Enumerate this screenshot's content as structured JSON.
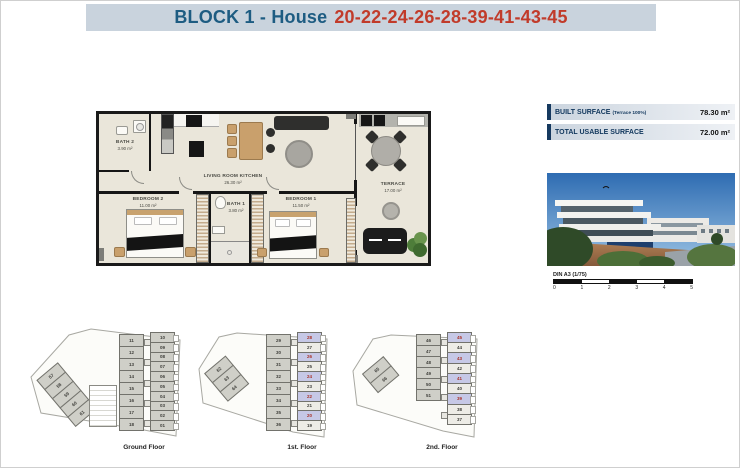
{
  "header": {
    "title_prefix": "BLOCK 1 - House",
    "title_numbers": "20-22-24-26-28-39-41-43-45"
  },
  "plan": {
    "rooms": {
      "bath2": {
        "name": "BATH 2",
        "area": "3.90 m²"
      },
      "living": {
        "name": "LIVING ROOM KITCHEN",
        "area": "26.30 m²"
      },
      "bedroom2": {
        "name": "BEDROOM 2",
        "area": "11.00 m²"
      },
      "bath1": {
        "name": "BATH 1",
        "area": "3.80 m²"
      },
      "bedroom1": {
        "name": "BEDROOM 1",
        "area": "11.50 m²"
      },
      "terrace": {
        "name": "TERRACE",
        "area": "17.00 m²"
      }
    }
  },
  "surface_table": {
    "rows": [
      {
        "label": "BUILT SURFACE",
        "note": "(Terrace 100%)",
        "value": "78.30 m²"
      },
      {
        "label": "TOTAL USABLE SURFACE",
        "note": "",
        "value": "72.00 m²"
      }
    ]
  },
  "scale_bar": {
    "label": "DIN A3 (1/75)",
    "ticks": [
      "0",
      "1",
      "2",
      "3",
      "4",
      "5"
    ]
  },
  "floors": [
    {
      "label": "Ground Floor",
      "strip": [
        {
          "n": "57",
          "t": "g"
        },
        {
          "n": "58",
          "t": "g"
        },
        {
          "n": "59",
          "t": "g"
        },
        {
          "n": "60",
          "t": "g"
        },
        {
          "n": "61",
          "t": "g"
        }
      ],
      "left_col": [
        {
          "n": "11",
          "t": "g"
        },
        {
          "n": "12",
          "t": "g"
        },
        {
          "n": "13",
          "t": "g"
        },
        {
          "n": "14",
          "t": "g"
        },
        {
          "n": "15",
          "t": "g"
        },
        {
          "n": "16",
          "t": "g"
        },
        {
          "n": "17",
          "t": "g"
        },
        {
          "n": "18",
          "t": "g"
        }
      ],
      "right_col": [
        {
          "n": "10",
          "t": "g"
        },
        {
          "n": "09",
          "t": "g"
        },
        {
          "n": "08",
          "t": "g"
        },
        {
          "n": "07",
          "t": "g"
        },
        {
          "n": "06",
          "t": "g"
        },
        {
          "n": "05",
          "t": "g"
        },
        {
          "n": "04",
          "t": "g"
        },
        {
          "n": "03",
          "t": "g"
        },
        {
          "n": "02",
          "t": "g"
        },
        {
          "n": "01",
          "t": "g"
        }
      ]
    },
    {
      "label": "1st. Floor",
      "strip": [
        {
          "n": "62",
          "t": "g"
        },
        {
          "n": "63",
          "t": "g"
        },
        {
          "n": "64",
          "t": "g"
        }
      ],
      "left_col": [
        {
          "n": "29",
          "t": "g"
        },
        {
          "n": "30",
          "t": "g"
        },
        {
          "n": "31",
          "t": "g"
        },
        {
          "n": "32",
          "t": "g"
        },
        {
          "n": "33",
          "t": "g"
        },
        {
          "n": "34",
          "t": "g"
        },
        {
          "n": "35",
          "t": "g"
        },
        {
          "n": "36",
          "t": "g"
        }
      ],
      "right_col": [
        {
          "n": "28",
          "t": "h"
        },
        {
          "n": "27",
          "t": "w"
        },
        {
          "n": "26",
          "t": "h"
        },
        {
          "n": "25",
          "t": "w"
        },
        {
          "n": "24",
          "t": "h"
        },
        {
          "n": "23",
          "t": "w"
        },
        {
          "n": "22",
          "t": "h"
        },
        {
          "n": "21",
          "t": "w"
        },
        {
          "n": "20",
          "t": "h"
        },
        {
          "n": "19",
          "t": "w"
        }
      ]
    },
    {
      "label": "2nd. Floor",
      "strip": [
        {
          "n": "65",
          "t": "g"
        },
        {
          "n": "66",
          "t": "g"
        }
      ],
      "left_col": [
        {
          "n": "46",
          "t": "g"
        },
        {
          "n": "47",
          "t": "g"
        },
        {
          "n": "48",
          "t": "g"
        },
        {
          "n": "49",
          "t": "g"
        },
        {
          "n": "50",
          "t": "g"
        },
        {
          "n": "51",
          "t": "g"
        }
      ],
      "right_col": [
        {
          "n": "45",
          "t": "h"
        },
        {
          "n": "44",
          "t": "w"
        },
        {
          "n": "43",
          "t": "h"
        },
        {
          "n": "42",
          "t": "w"
        },
        {
          "n": "41",
          "t": "h"
        },
        {
          "n": "40",
          "t": "w"
        },
        {
          "n": "39",
          "t": "h"
        },
        {
          "n": "38",
          "t": "w"
        },
        {
          "n": "37",
          "t": "w"
        }
      ]
    }
  ],
  "colors": {
    "header_bg": "#c9d3dd",
    "title_blue": "#1d5c82",
    "title_red": "#c13b2a",
    "table_bar": "#16395f",
    "highlight_unit": "#c6c8e6",
    "unit_gray": "#cfcfc8",
    "red_number": "#a8322a"
  }
}
